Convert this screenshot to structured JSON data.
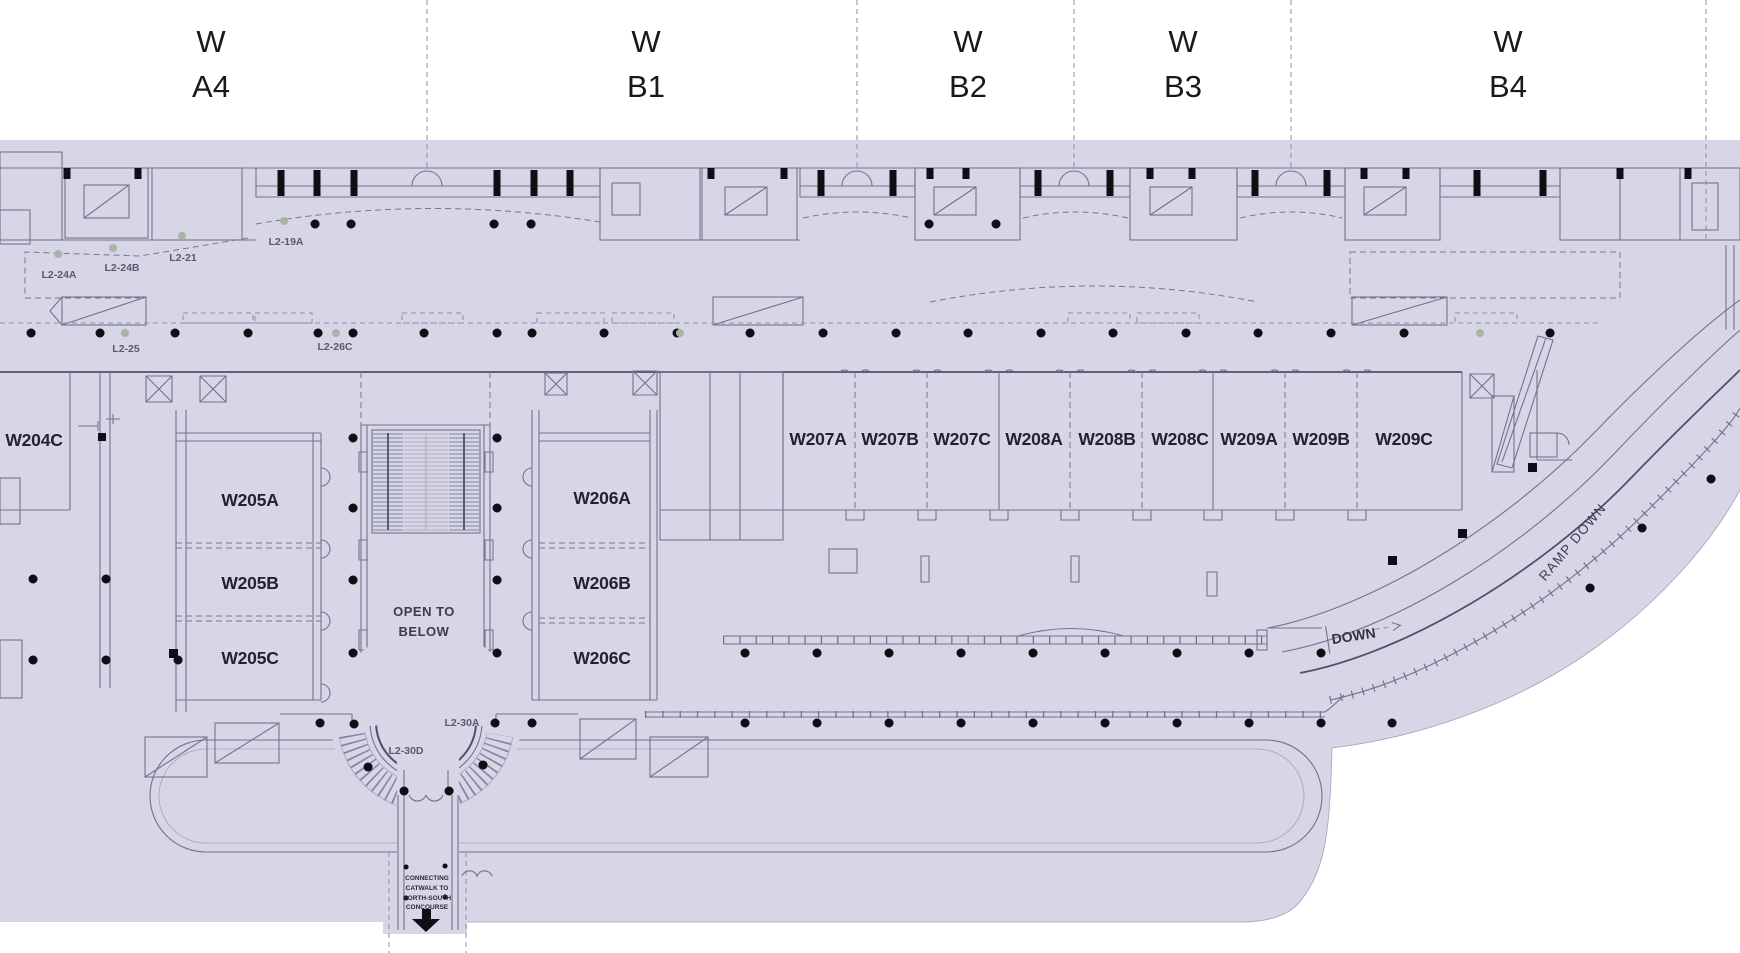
{
  "grid_columns": [
    {
      "line1": "W",
      "line2": "A4"
    },
    {
      "line1": "W",
      "line2": "B1"
    },
    {
      "line1": "W",
      "line2": "B2"
    },
    {
      "line1": "W",
      "line2": "B3"
    },
    {
      "line1": "W",
      "line2": "B4"
    }
  ],
  "rooms": {
    "w204c": "W204C",
    "w205a": "W205A",
    "w205b": "W205B",
    "w205c": "W205C",
    "w206a": "W206A",
    "w206b": "W206B",
    "w206c": "W206C",
    "w207a": "W207A",
    "w207b": "W207B",
    "w207c": "W207C",
    "w208a": "W208A",
    "w208b": "W208B",
    "w208c": "W208C",
    "w209a": "W209A",
    "w209b": "W209B",
    "w209c": "W209C"
  },
  "location_tags": {
    "l2_19a": "L2-19A",
    "l2_21": "L2-21",
    "l2_24a": "L2-24A",
    "l2_24b": "L2-24B",
    "l2_25": "L2-25",
    "l2_26c": "L2-26C",
    "l2_30a": "L2-30A",
    "l2_30d": "L2-30D"
  },
  "annotations": {
    "open_to_below": {
      "line1": "OPEN TO",
      "line2": "BELOW"
    },
    "ramp_down": "RAMP DOWN",
    "down": "DOWN",
    "catwalk_note": {
      "line1": "CONNECTING",
      "line2": "CATWALK TO",
      "line3": "NORTH-SOUTH",
      "line4": "CONCOURSE"
    }
  },
  "colors": {
    "background": "#ffffff",
    "floor": "#d7d6e7",
    "walls": "#73728e",
    "walls_dark": "#4f4e6b",
    "column_dots": "#0e0e14",
    "muted_dots": "#a9b3a7",
    "room_label": "#232330",
    "tag_label": "#5a5970"
  }
}
